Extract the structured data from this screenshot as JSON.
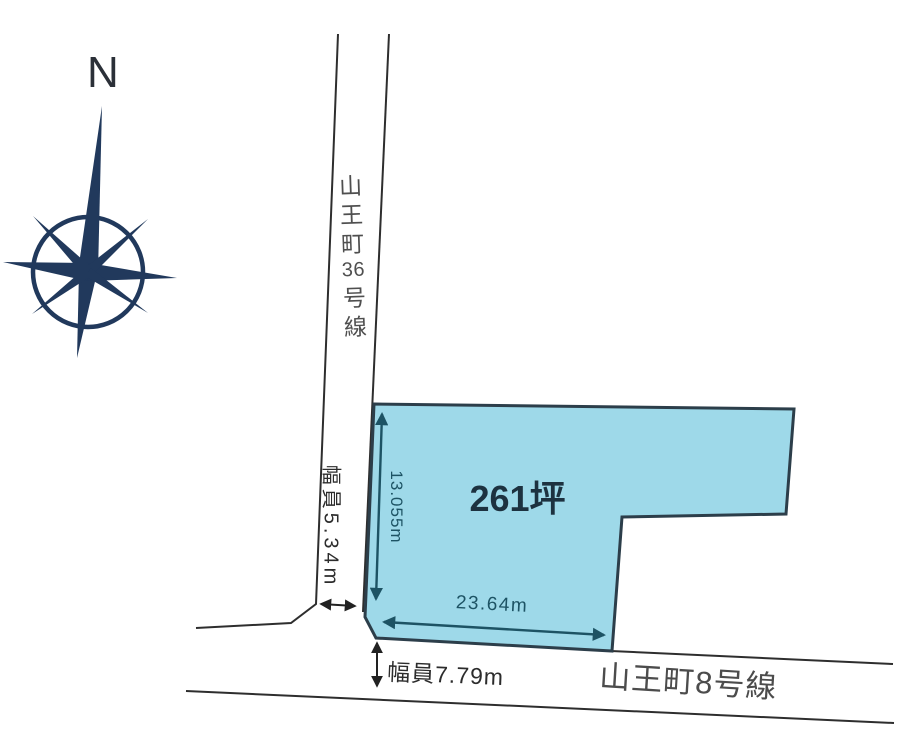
{
  "compass": {
    "north_label": "N",
    "color": "#21395c"
  },
  "plot": {
    "area_label": "261坪",
    "width_label": "23.64m",
    "depth_label": "13.055m",
    "fill_color": "#9ed9e9",
    "outline_color": "#2c3e4a",
    "dimension_color": "#1d5364"
  },
  "roads": {
    "vertical": {
      "name": "山王町36号線",
      "name_chars": [
        "山",
        "王",
        "町",
        "36",
        "号",
        "線"
      ],
      "width_label": "幅員5.34m"
    },
    "horizontal": {
      "name": "山王町8号線",
      "width_label": "幅員7.79m"
    },
    "line_color": "#2e2e2e",
    "width_arrow_color": "#222222"
  }
}
